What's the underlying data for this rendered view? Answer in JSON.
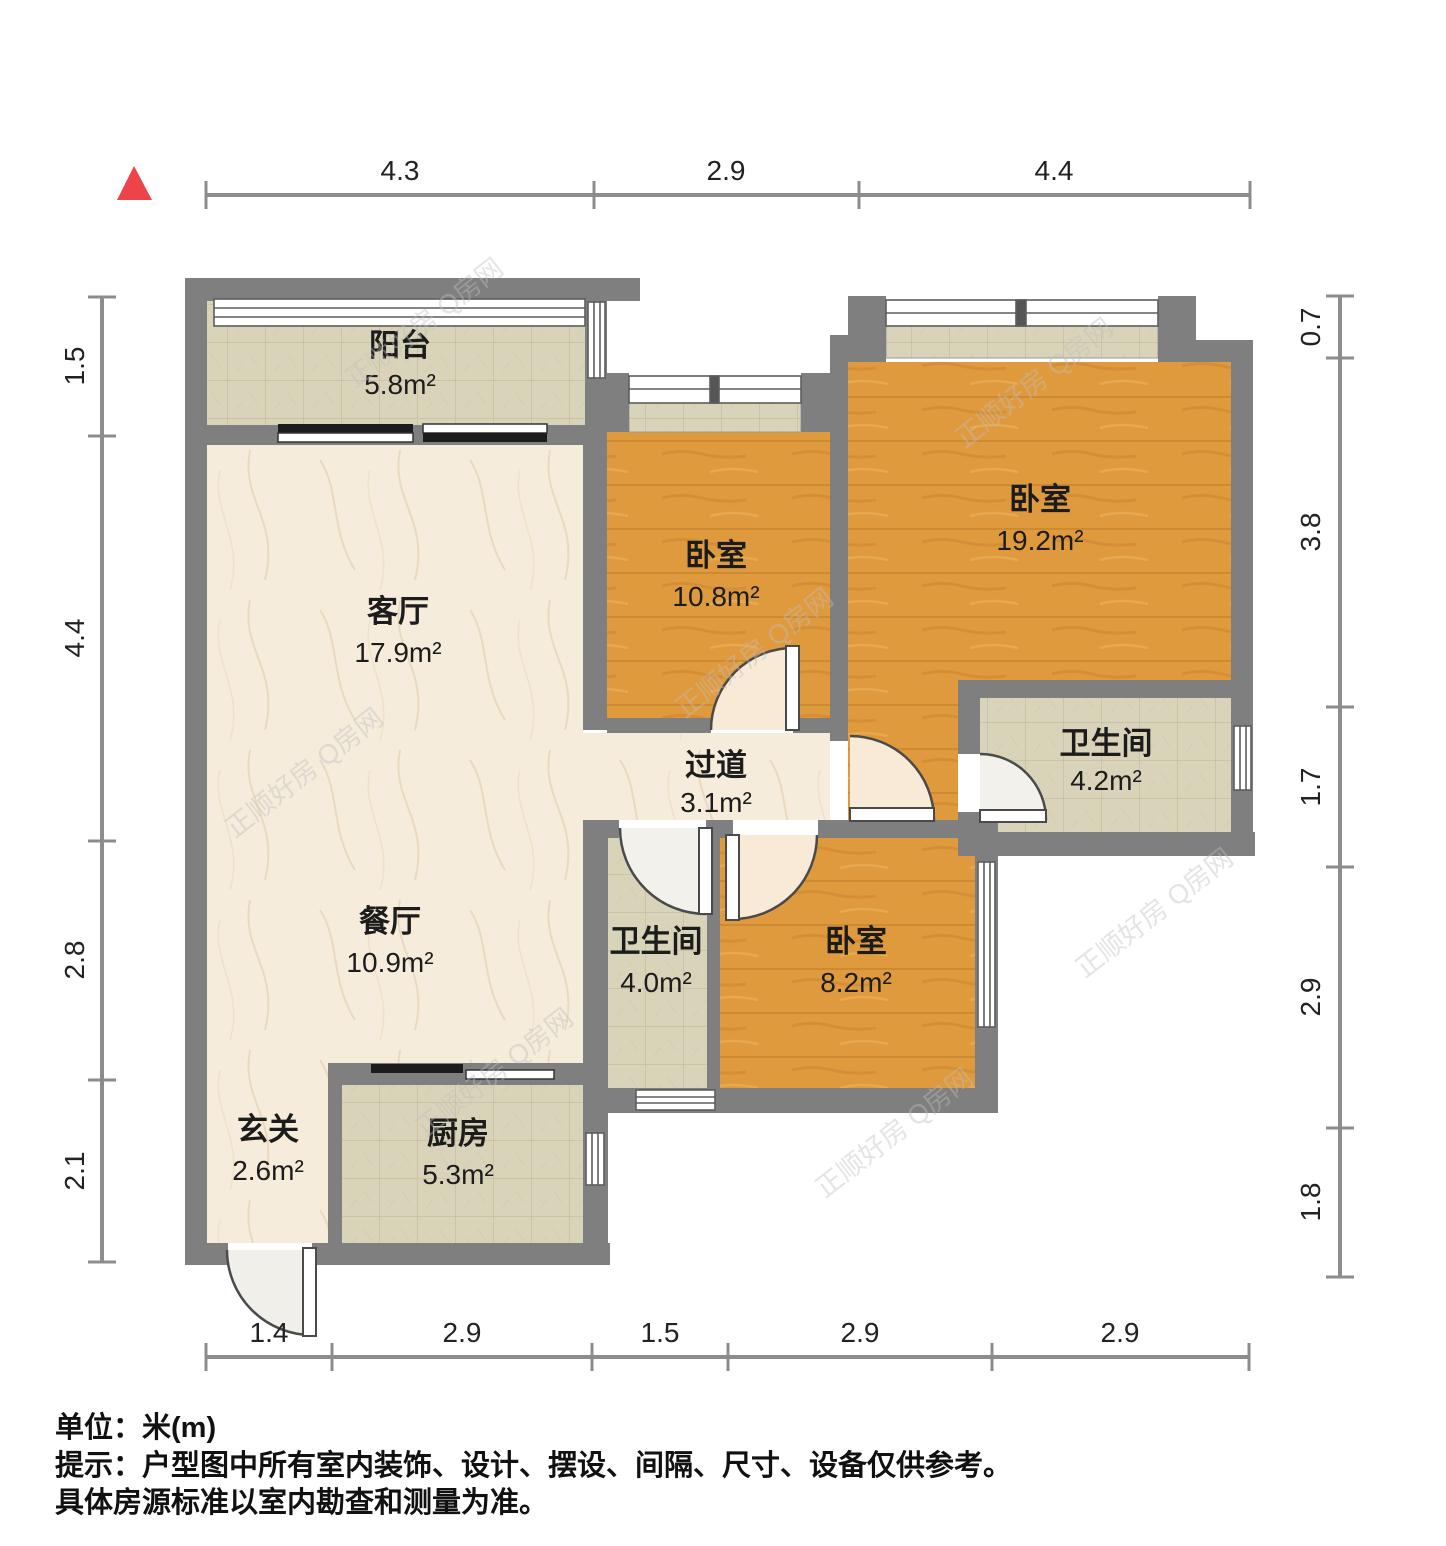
{
  "plan": {
    "title": "户型图",
    "unit": "米(m)"
  },
  "rooms": {
    "balcony": {
      "name": "阳台",
      "area": "5.8m²"
    },
    "living": {
      "name": "客厅",
      "area": "17.9m²"
    },
    "dining": {
      "name": "餐厅",
      "area": "10.9m²"
    },
    "entry": {
      "name": "玄关",
      "area": "2.6m²"
    },
    "kitchen": {
      "name": "厨房",
      "area": "5.3m²"
    },
    "bedroom_a": {
      "name": "卧室",
      "area": "10.8m²"
    },
    "bedroom_b": {
      "name": "卧室",
      "area": "19.2m²"
    },
    "bedroom_c": {
      "name": "卧室",
      "area": "8.2m²"
    },
    "hallway": {
      "name": "过道",
      "area": "3.1m²"
    },
    "bath_a": {
      "name": "卫生间",
      "area": "4.0m²"
    },
    "bath_b": {
      "name": "卫生间",
      "area": "4.2m²"
    }
  },
  "dimensions": {
    "top": [
      "4.3",
      "2.9",
      "4.4"
    ],
    "bottom": [
      "1.4",
      "2.9",
      "1.5",
      "2.9",
      "2.9"
    ],
    "left": [
      "1.5",
      "4.4",
      "2.8",
      "2.1"
    ],
    "right": [
      "0.7",
      "3.8",
      "1.7",
      "2.9",
      "1.8"
    ]
  },
  "watermark": {
    "text": "正顺好房 Q房网"
  },
  "footer": {
    "unit_line": "单位：米(m)",
    "tip_line1": "提示：户型图中所有室内装饰、设计、摆设、间隔、尺寸、设备仅供参考。",
    "tip_line2": "具体房源标准以室内勘查和测量为准。"
  },
  "colors": {
    "wall": "#7f7f7f",
    "wood": "#e09a3e",
    "tile": "#d9d4b9",
    "marble": "#f5ecdb",
    "north_arrow": "#ee4449"
  }
}
